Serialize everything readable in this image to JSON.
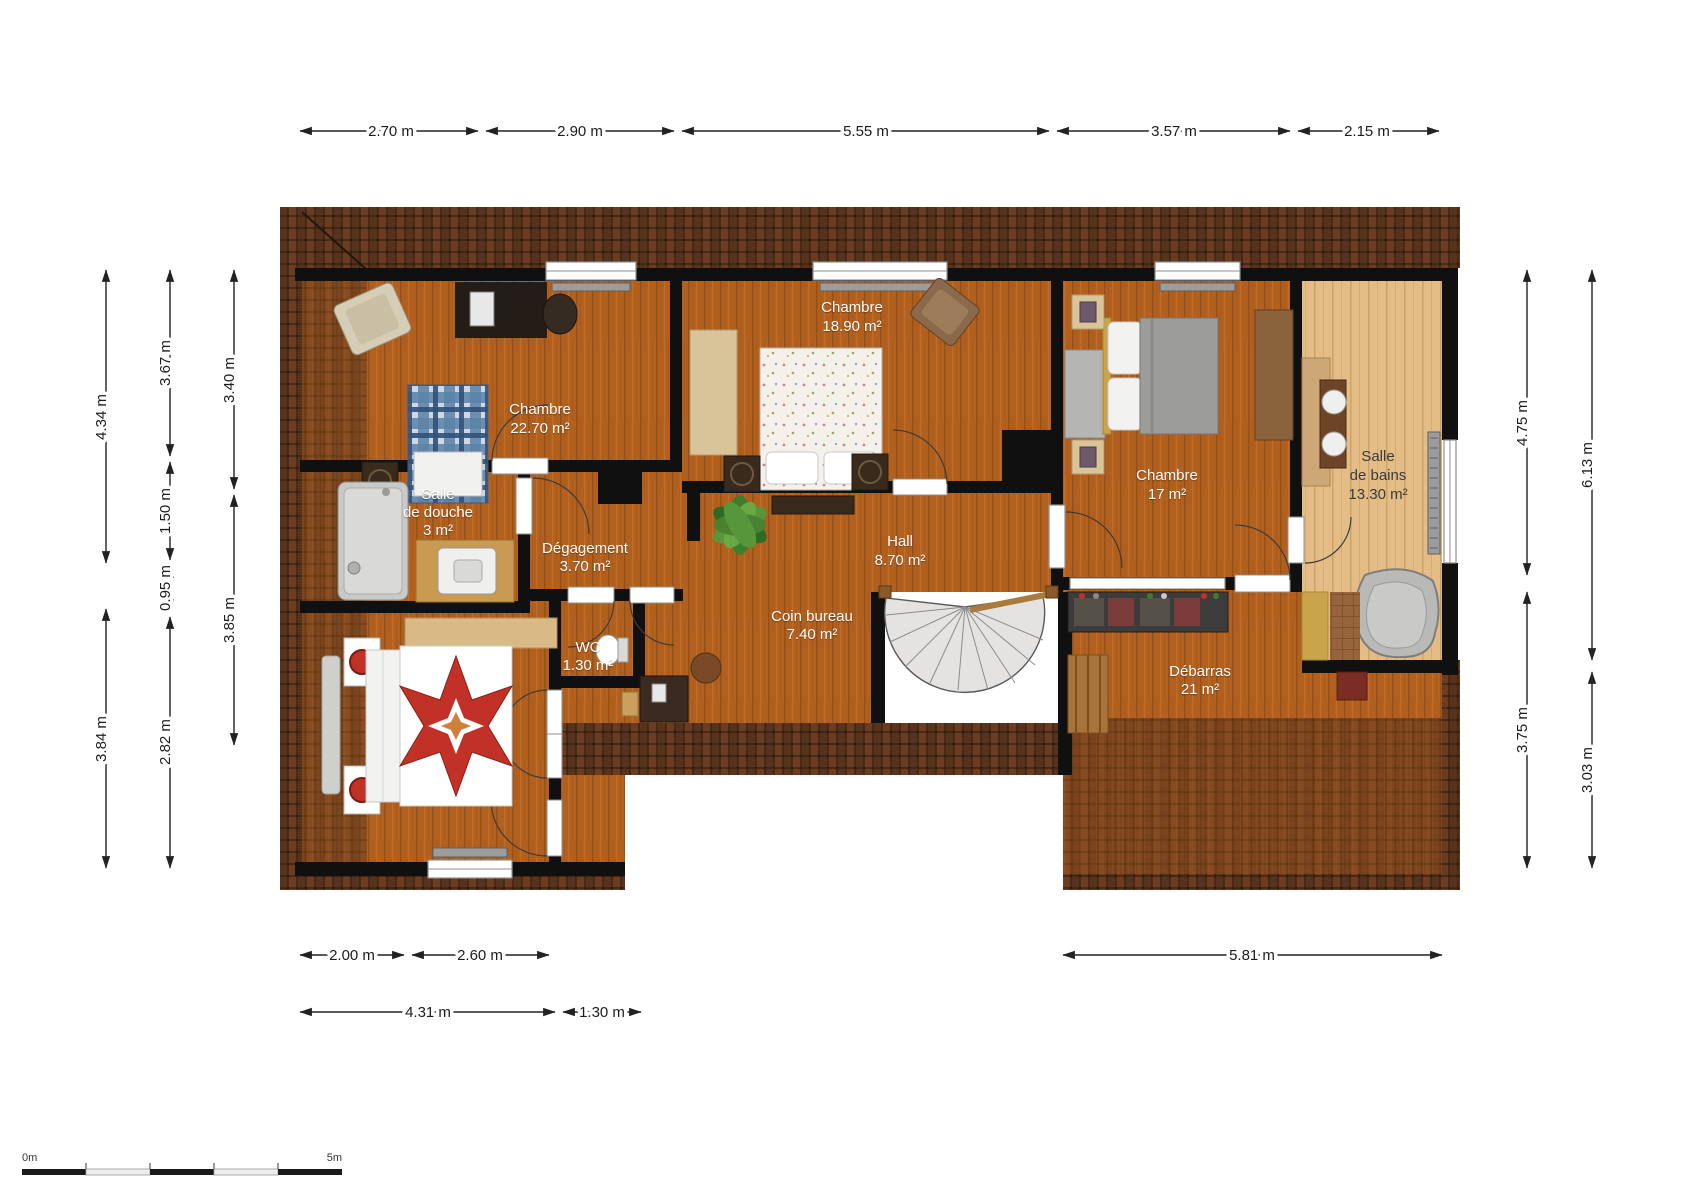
{
  "plan": {
    "type": "floor-plan",
    "rooms": [
      {
        "id": "chambre-22",
        "name": "Chambre",
        "area": "22.70 m²"
      },
      {
        "id": "chambre-18",
        "name": "Chambre",
        "area": "18.90 m²"
      },
      {
        "id": "chambre-17",
        "name": "Chambre",
        "area": "17 m²"
      },
      {
        "id": "salle-de-bains",
        "name_line1": "Salle",
        "name_line2": "de bains",
        "area": "13.30 m²"
      },
      {
        "id": "salle-de-douche",
        "name_line1": "Salle",
        "name_line2": "de douche",
        "area": "3 m²"
      },
      {
        "id": "degagement",
        "name": "Dégagement",
        "area": "3.70 m²"
      },
      {
        "id": "hall",
        "name": "Hall",
        "area": "8.70 m²"
      },
      {
        "id": "wc",
        "name": "WC",
        "area": "1.30 m²"
      },
      {
        "id": "coin-bureau",
        "name": "Coin bureau",
        "area": "7.40 m²"
      },
      {
        "id": "debarras",
        "name": "Débarras",
        "area": "21 m²"
      }
    ],
    "dimensions": {
      "top": [
        "2.70 m",
        "2.90 m",
        "5.55 m",
        "3.57 m",
        "2.15 m"
      ],
      "left_outer": [
        "4.34 m",
        "3.84 m"
      ],
      "left_middle": [
        "3.67 m",
        "1.50 m",
        "0.95 m",
        "2.82 m"
      ],
      "left_inner": [
        "3.40 m",
        "3.85 m"
      ],
      "right_inner": [
        "4.75 m",
        "3.75 m"
      ],
      "right_outer": [
        "6.13 m",
        "3.03 m"
      ],
      "bottom_row1": [
        "2.00 m",
        "2.60 m",
        "5.81 m"
      ],
      "bottom_row2": [
        "4.31 m",
        "1.30 m"
      ]
    },
    "scale_bar": {
      "start_label": "0m",
      "end_label": "5m"
    },
    "colors": {
      "floor_wood": "#b2601f",
      "floor_light_wood": "#e3bc86",
      "roof_tiles": "#4a2b19",
      "wall": "#101010",
      "room_label": "#ffffff",
      "bath_label": "#3a3a3a",
      "dimension_text": "#1c1c1c",
      "quilt_red": "#c23127",
      "bed_plaid_blue": "#5b82a8"
    }
  }
}
